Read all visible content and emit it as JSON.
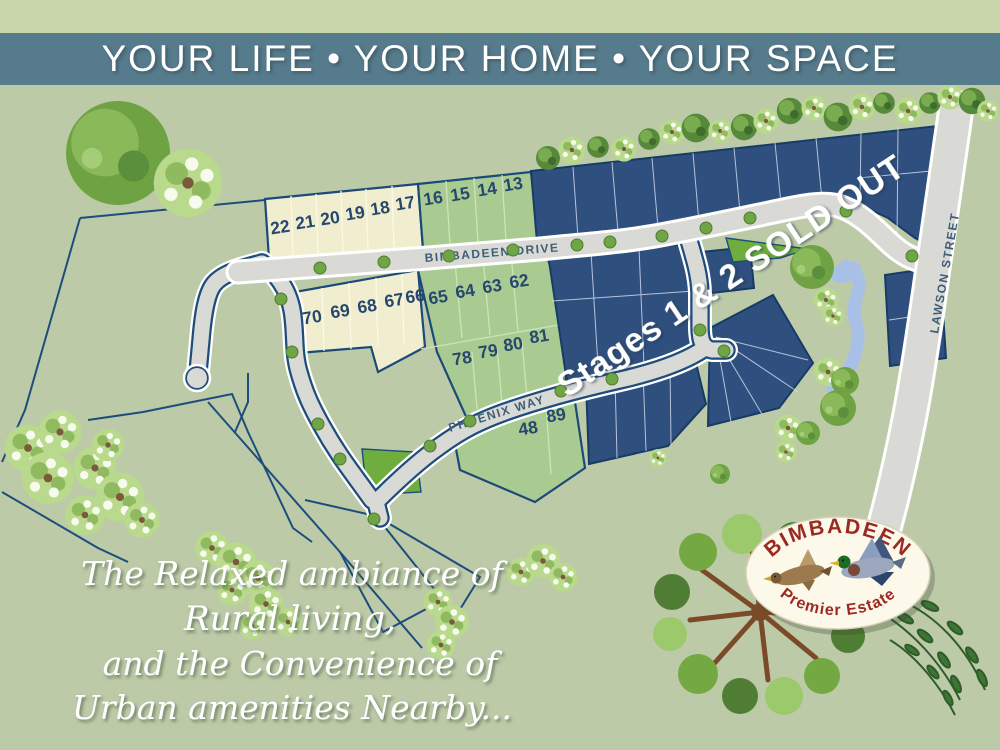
{
  "header": {
    "title": "YOUR LIFE • YOUR HOME • YOUR SPACE"
  },
  "map": {
    "streets": {
      "bimbadeen": "BIMBADEEN DRIVE",
      "phoenix": "PHOENIX WAY",
      "lawson": "LAWSON STREET"
    },
    "sold_overlay": "Stages 1 & 2 SOLD OUT",
    "lots": {
      "top_cream": [
        "22",
        "21",
        "20",
        "19",
        "18",
        "17"
      ],
      "top_green": [
        "16",
        "15",
        "14",
        "13"
      ],
      "mid_cream": [
        "70",
        "69",
        "68",
        "67",
        "66"
      ],
      "mid_green": [
        "65",
        "64",
        "63",
        "62"
      ],
      "lower_green": [
        "78",
        "79",
        "80",
        "81"
      ],
      "south_green": [
        "48",
        "89"
      ]
    },
    "colors": {
      "sold_blue": "#2f4f7e",
      "available_cream": "#f0eecf",
      "available_green": "#a9cb92",
      "road_grey": "#d9d9d5",
      "water_blue": "#a8c0e6",
      "park_green": "#6fae3e"
    }
  },
  "tagline": {
    "line1": "The Relaxed ambiance of",
    "line2": "Rural living,",
    "line3": "and the Convenience of",
    "line4": "Urban amenities Nearby..."
  },
  "logo": {
    "title": "BIMBADEEN",
    "subtitle": "Premier Estate"
  }
}
